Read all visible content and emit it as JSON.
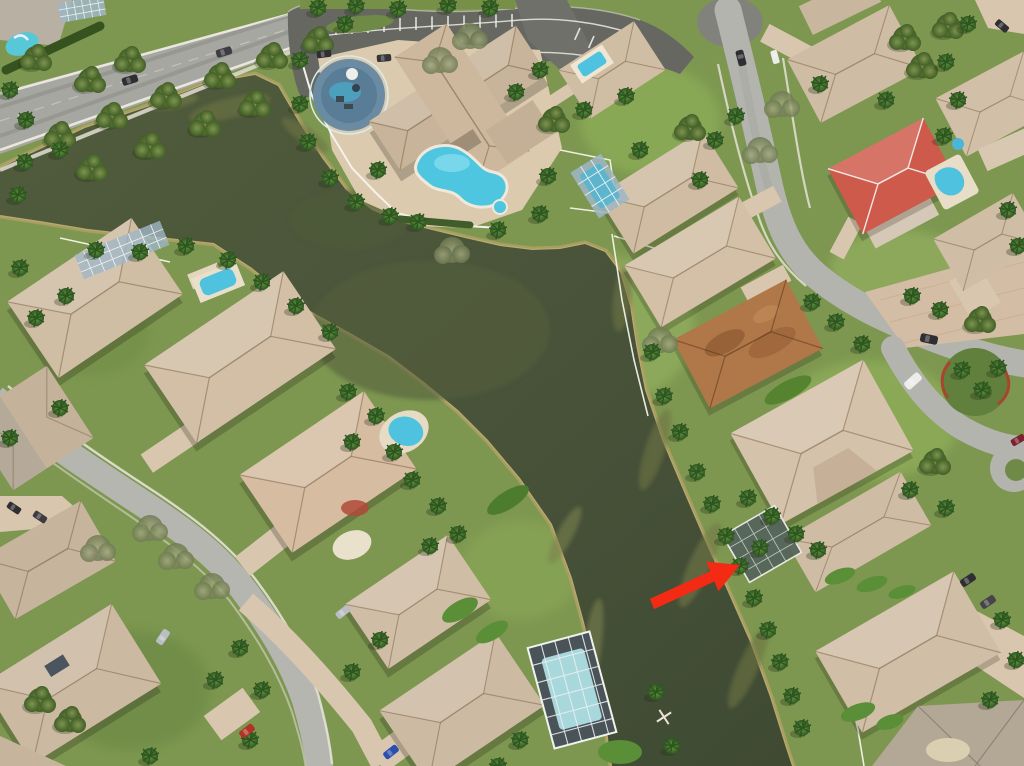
{
  "scene": {
    "type": "aerial-photograph",
    "description": "Overhead drone photo of a Florida residential community: winding dark lagoon canal, clubhouse with kidney pool and parking lot, tile-roof homes, screened pools, palm trees, curving streets; a red arrow annotation marks a waterfront lot on the east bank of the canal.",
    "labels": {
      "water": "lake-canal",
      "clubhouse": "community-clubhouse",
      "clubhouse_pool": "kidney-pool",
      "splash_pad": "splash-pad",
      "parking": "clubhouse-parking-lot",
      "boulevard": "main-boulevard",
      "arrow": "listing-location-arrow",
      "x_marker": "survey-x-marker"
    }
  },
  "palette": {
    "grass": "#7d9750",
    "grass_light": "#93ad5e",
    "grass_dark": "#5d773c",
    "water": "#4c563a",
    "water_light": "#56613e",
    "sand": "#ab9e62",
    "sand_light": "#c6ba7c",
    "road": "#b4b4ae",
    "road_dark": "#8f8f89",
    "asphalt": "#66665f",
    "paver": "#d9c6ae",
    "deck": "#dccaaf",
    "fence": "#f4f2ea",
    "roof_tan": "#cfbca4",
    "roof_pink": "#d6bda2",
    "roof_gray": "#b7b0a3",
    "roof_rust": "#b07748",
    "roof_red": "#ce5a4c",
    "pool_blue": "#4ec6e0",
    "pool_pale": "#a8d8dc",
    "cage": "#8fa9ba",
    "car_dark": "#2e2e33",
    "car_white": "#ececea",
    "car_silver": "#babec2",
    "car_red": "#b03326",
    "car_blue": "#2a4fae",
    "arrow": "#f32b15"
  },
  "annotation": {
    "arrow_color": "#f32b15",
    "arrow_points": "649.9,598.9 710.2,571.3 706.2,561.6 740,565 718.4,591.2 714.4,581.5 654.1,609.1",
    "x_marker_transform": "translate(664,717) rotate(12)"
  }
}
